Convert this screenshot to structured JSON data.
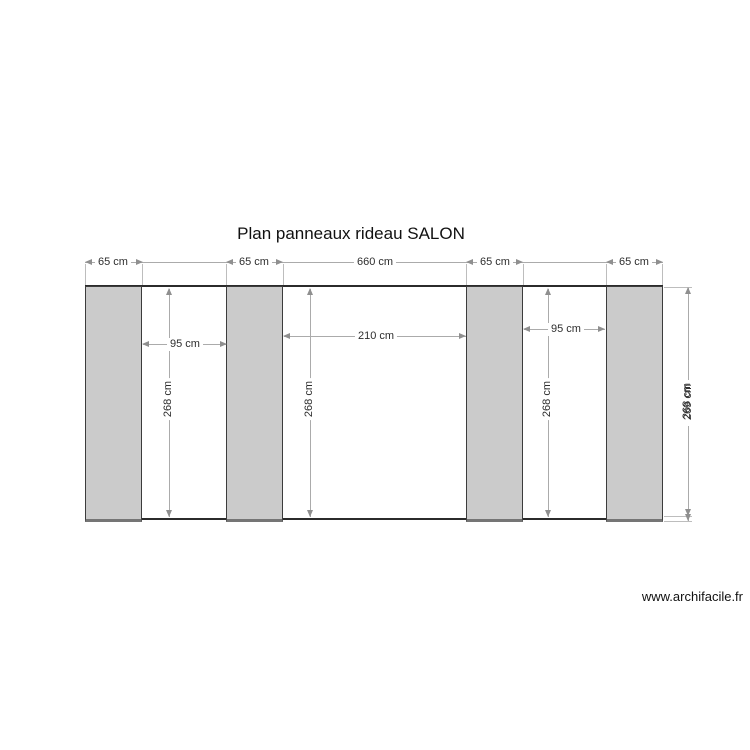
{
  "title": "Plan panneaux rideau SALON",
  "watermark": "www.archifacile.fr",
  "colors": {
    "panel_fill": "#cbcbcb",
    "panel_border": "#3c3c3c",
    "dimension_line": "#ababab",
    "wall_line": "#2b2b2b",
    "text": "#2e2e2e"
  },
  "dims": {
    "top": {
      "panel1_width": "65 cm",
      "panel2_width": "65 cm",
      "total_width": "660 cm",
      "panel3_width": "65 cm",
      "panel4_width": "65 cm"
    },
    "gaps": {
      "gap1": "95 cm",
      "gap2": "210 cm",
      "gap3": "95 cm"
    },
    "heights": {
      "h1": "268 cm",
      "h2": "268 cm",
      "h3": "268 cm"
    },
    "outer_height": {
      "primary": "268 cm",
      "overlapped": "269 cm"
    }
  }
}
